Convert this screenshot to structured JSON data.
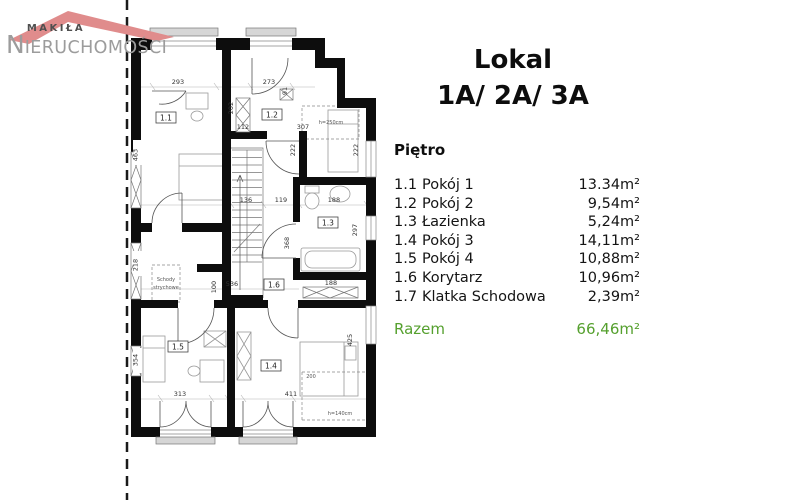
{
  "logo": {
    "top": "MAKIŁA",
    "main_initial": "N",
    "main_rest": "IERUCHOMOŚCI"
  },
  "colors": {
    "roof": "#e08c8c",
    "logo_top_text": "#4f4f4f",
    "logo_main_text": "#9c9c9c",
    "total_green": "#55a02e",
    "walls": "#0d0d0d"
  },
  "panel": {
    "title_line1": "Lokal",
    "title_line2": "1A/ 2A/ 3A",
    "floor_label": "Piętro",
    "rooms": [
      {
        "num": "1.1",
        "name": "Pokój 1",
        "area": "13.34m²"
      },
      {
        "num": "1.2",
        "name": "Pokój 2",
        "area": "9,54m²"
      },
      {
        "num": "1.3",
        "name": "Łazienka",
        "area": "5,24m²"
      },
      {
        "num": "1.4",
        "name": "Pokój 3",
        "area": "14,11m²"
      },
      {
        "num": "1.5",
        "name": "Pokój 4",
        "area": "10,88m²"
      },
      {
        "num": "1.6",
        "name": "Korytarz",
        "area": "10,96m²"
      },
      {
        "num": "1.7",
        "name": "Klatka Schodowa",
        "area": "2,39m²"
      }
    ],
    "total_label": "Razem",
    "total_area": "66,46m²"
  },
  "plan": {
    "labels": {
      "r11": "1.1",
      "r12": "1.2",
      "r13": "1.3",
      "r14": "1.4",
      "r15": "1.5",
      "r16": "1.6"
    },
    "dims": {
      "d293": "293",
      "d273": "273",
      "d91": "91",
      "d112": "112",
      "d202": "202",
      "d307": "307",
      "d222a": "222",
      "d222b": "222",
      "d463": "463",
      "d136": "136",
      "d119": "119",
      "d188a": "188",
      "d218": "218",
      "d100": "100",
      "d536": "536",
      "d368": "368",
      "d297": "297",
      "d188b": "188",
      "d425": "425",
      "d354": "354",
      "d313": "313",
      "d411": "411"
    },
    "notes": {
      "attic1": "Schody",
      "attic2": "strychowe",
      "niche": "h=250cm",
      "bed_len": "200",
      "roof_height": "h=140cm"
    }
  }
}
